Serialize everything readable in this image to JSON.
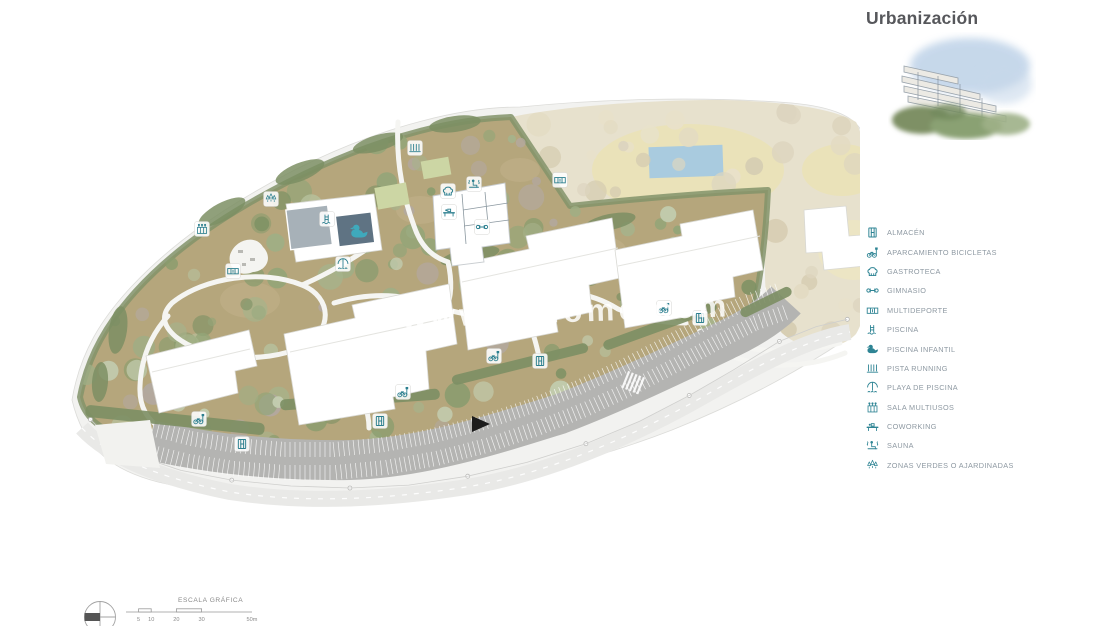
{
  "header": {
    "title": "Urbanización"
  },
  "legend": {
    "items": [
      {
        "icon": "almacen",
        "label": "ALMACÉN"
      },
      {
        "icon": "bicicletas",
        "label": "APARCAMIENTO BICICLETAS"
      },
      {
        "icon": "gastroteca",
        "label": "GASTROTECA"
      },
      {
        "icon": "gimnasio",
        "label": "GIMNASIO"
      },
      {
        "icon": "multideporte",
        "label": "MULTIDEPORTE"
      },
      {
        "icon": "piscina",
        "label": "PISCINA"
      },
      {
        "icon": "piscina-infantil",
        "label": "PISCINA INFANTIL"
      },
      {
        "icon": "pista-running",
        "label": "PISTA RUNNING"
      },
      {
        "icon": "playa-piscina",
        "label": "PLAYA DE PISCINA"
      },
      {
        "icon": "sala-multiusos",
        "label": "SALA MULTIUSOS"
      },
      {
        "icon": "coworking",
        "label": "COWORKING"
      },
      {
        "icon": "sauna",
        "label": "SAUNA"
      },
      {
        "icon": "zonas-verdes",
        "label": "ZONAS VERDES O AJARDINADAS"
      }
    ]
  },
  "plan": {
    "watermark": "www.orhome.com",
    "colors": {
      "icon_teal": "#2c7f8f",
      "ground_tan": "#b5a67c",
      "future_parcel_beige": "#e7e1cd",
      "pool_blue": "#a9cbdf",
      "parking_gray": "#b4b4b2",
      "green_verge": "#7d8f64"
    },
    "markers": [
      {
        "icon": "pista-running",
        "x": 415,
        "y": 148
      },
      {
        "icon": "multideporte",
        "x": 560,
        "y": 180
      },
      {
        "icon": "sauna",
        "x": 474,
        "y": 184
      },
      {
        "icon": "gastroteca",
        "x": 448,
        "y": 191
      },
      {
        "icon": "coworking",
        "x": 449,
        "y": 212
      },
      {
        "icon": "gimnasio",
        "x": 482,
        "y": 227
      },
      {
        "icon": "piscina",
        "x": 327,
        "y": 219
      },
      {
        "icon": "piscina-infantil",
        "x": 359,
        "y": 232,
        "chip": false
      },
      {
        "icon": "playa-piscina",
        "x": 343,
        "y": 264
      },
      {
        "icon": "zonas-verdes",
        "x": 271,
        "y": 199
      },
      {
        "icon": "sala-multiusos",
        "x": 202,
        "y": 229
      },
      {
        "icon": "multideporte",
        "x": 233,
        "y": 271
      },
      {
        "icon": "bicicletas",
        "x": 199,
        "y": 419
      },
      {
        "icon": "almacen",
        "x": 242,
        "y": 444
      },
      {
        "icon": "bicicletas",
        "x": 403,
        "y": 392
      },
      {
        "icon": "almacen",
        "x": 380,
        "y": 421
      },
      {
        "icon": "bicicletas",
        "x": 494,
        "y": 356
      },
      {
        "icon": "almacen",
        "x": 540,
        "y": 361
      },
      {
        "icon": "bicicletas",
        "x": 664,
        "y": 308
      },
      {
        "icon": "almacen",
        "x": 700,
        "y": 318
      }
    ]
  },
  "scale_bar": {
    "title": "ESCALA GRÁFICA",
    "ticks": [
      "5",
      "10",
      "20",
      "30",
      "50m"
    ]
  }
}
